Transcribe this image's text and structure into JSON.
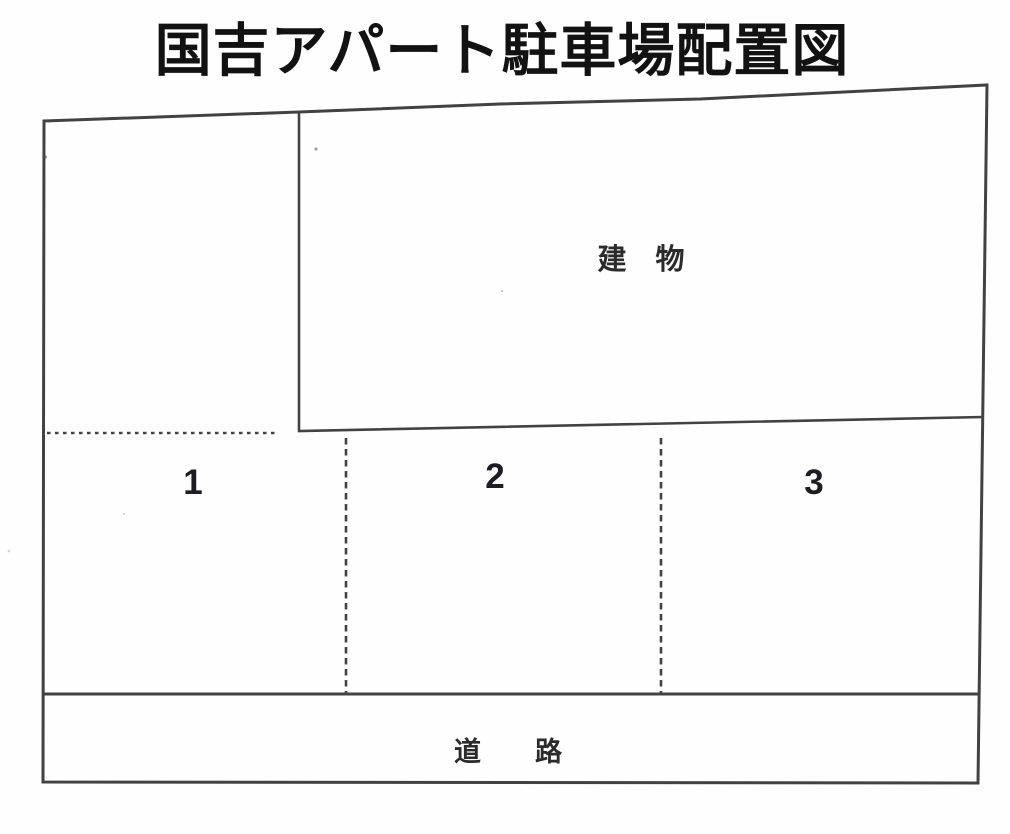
{
  "title": "国吉アパート駐車場配置図",
  "diagram": {
    "building_label": "建　物",
    "road_label": "道　　路",
    "spaces": [
      {
        "number": "1"
      },
      {
        "number": "2"
      },
      {
        "number": "3"
      }
    ]
  },
  "colors": {
    "line": "#424242",
    "title_text": "#121212",
    "label_text": "#2b2b2b",
    "number_text": "#1c1c24",
    "background": "#fefefe"
  }
}
